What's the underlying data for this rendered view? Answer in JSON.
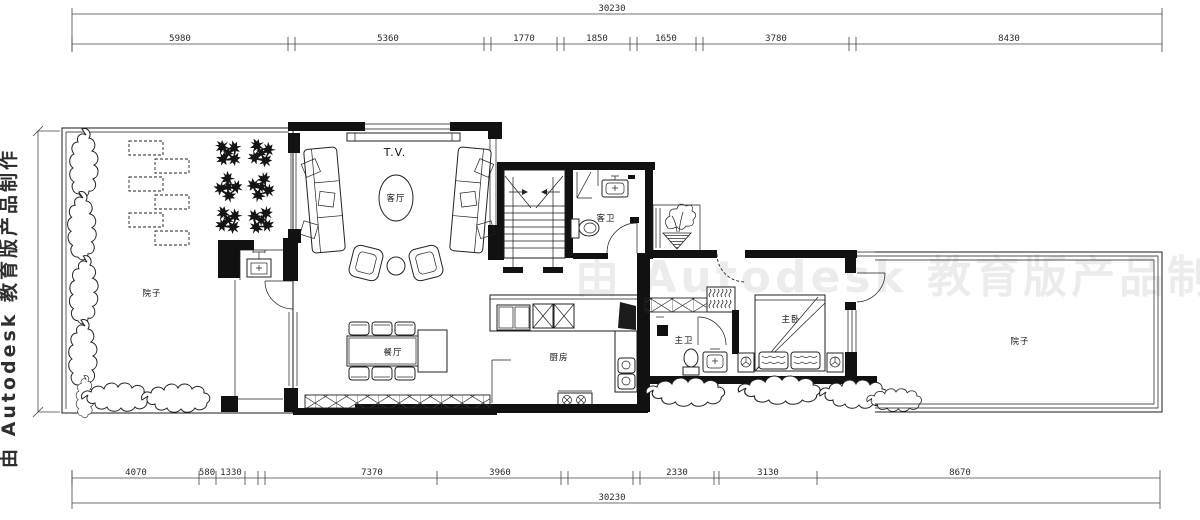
{
  "watermarks": {
    "left": "由 Autodesk 教育版产品制作",
    "center": "由 Autodesk 教育版产品制作"
  },
  "rooms": {
    "living_room": "客厅",
    "dining_room": "餐厅",
    "kitchen": "厨房",
    "master_bedroom": "主卧",
    "master_bathroom": "主卫",
    "guest_bathroom": "客卫",
    "courtyard_left": "院子",
    "courtyard_right": "院子",
    "tv_label": "T.V."
  },
  "dimensions": {
    "top_total": "30230",
    "top_segments": [
      "5980",
      "5360",
      "1770",
      "1850",
      "1650",
      "3780",
      "8430"
    ],
    "bottom_segments": [
      "4070",
      "580",
      "1330",
      "7370",
      "3960",
      "2330",
      "3130",
      "8670"
    ],
    "bottom_total": "30230"
  }
}
